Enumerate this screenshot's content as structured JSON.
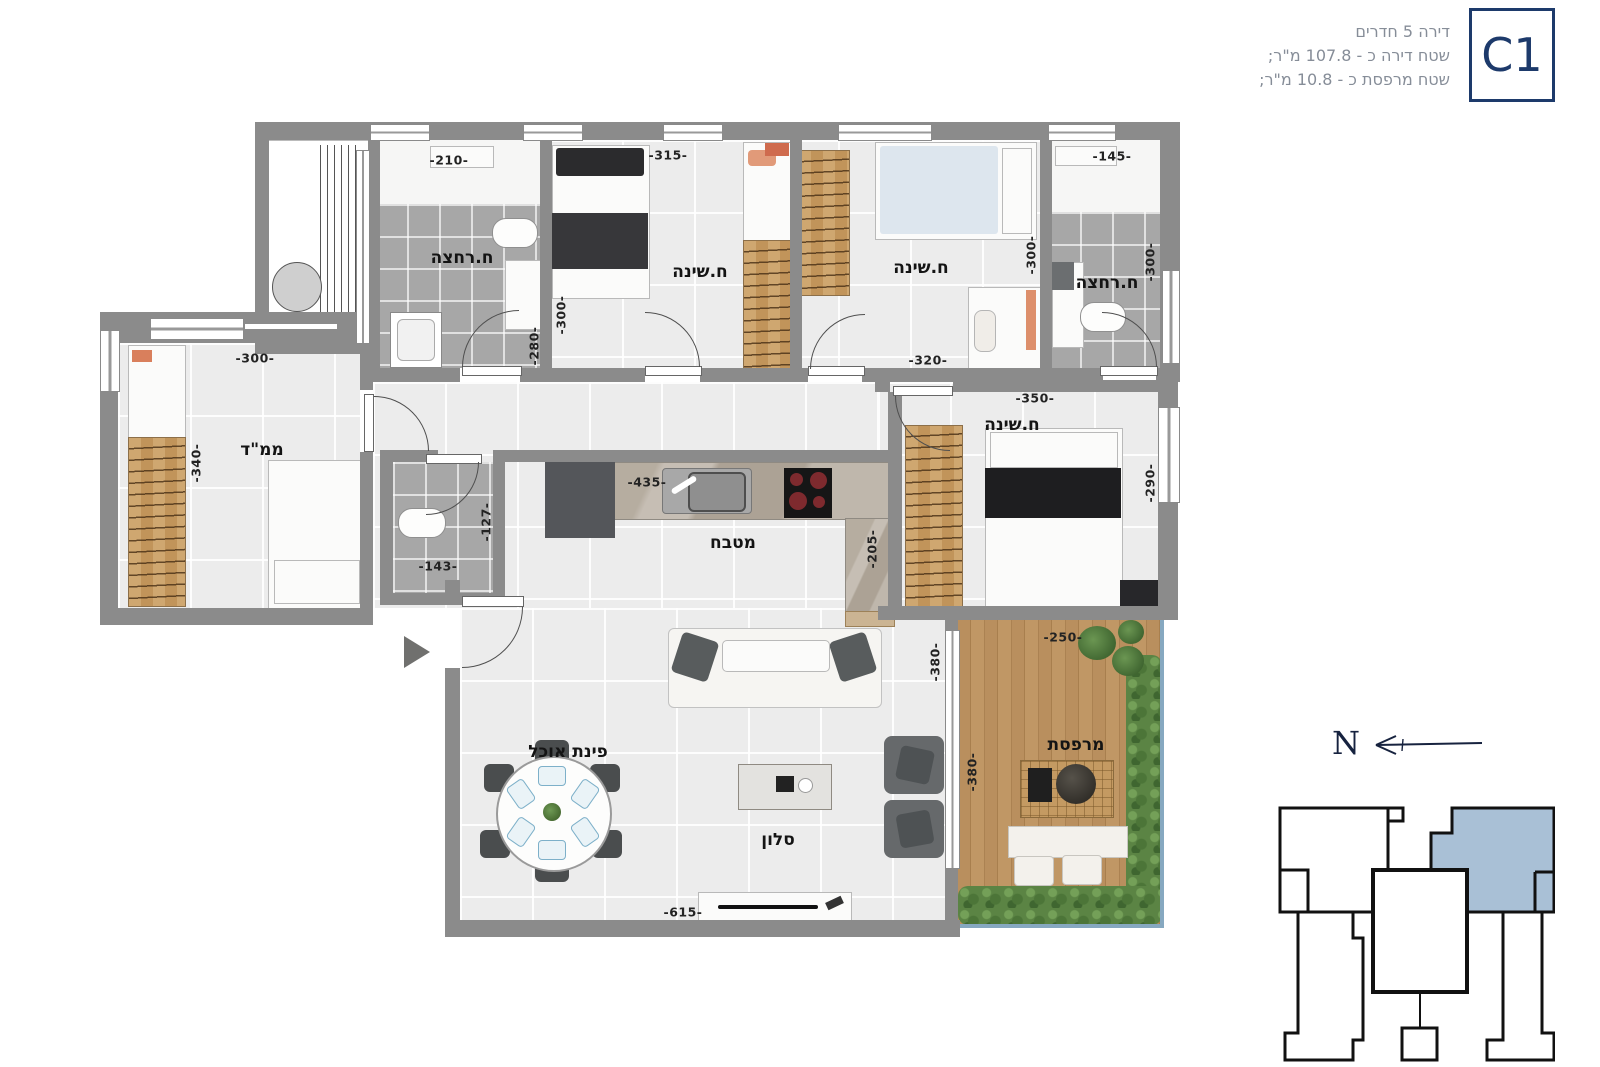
{
  "header": {
    "badge": "C1",
    "lines": {
      "l1": "דירה 5 חדרים",
      "l2": "שטח דירה כ - 107.8 מ\"ר;",
      "l3": "שטח מרפסת כ - 10.8 מ\"ר;"
    }
  },
  "labels": {
    "bath1": "ח.רחצה",
    "bedroom1": "ח.שינה",
    "bedroom2": "ח.שינה",
    "bath2": "ח.רחצה",
    "mamad": "ממ\"ד",
    "kitchen": "מטבח",
    "bedroom3": "ח.שינה",
    "dining": "פינת אוכל",
    "living": "סלון",
    "balcony": "מרפסת"
  },
  "dims": {
    "bath1_w": "-210-",
    "bath1_h": "-280-",
    "bedroom1_w": "-315-",
    "bedroom1_h": "-300-",
    "bedroom2_w": "-320-",
    "bedroom2_h": "-300-",
    "bath2_w": "-145-",
    "bath2_h": "-300-",
    "mamad_w": "-300-",
    "mamad_h": "-340-",
    "wc_w": "-143-",
    "wc_h": "-127-",
    "kitchen_w": "-435-",
    "kitchen_h": "-205-",
    "bedroom3_w": "-350-",
    "bedroom3_h": "-290-",
    "living_w": "-615-",
    "living_h": "-380-",
    "balcony_w": "-250-",
    "balcony_h": "-380-"
  },
  "compass": {
    "north": "N"
  },
  "colors": {
    "wall": "#8b8b8b",
    "floor": "#ececec",
    "bath_floor": "#a7a7a7",
    "wood": "#c1945a",
    "accent_navy": "#1d3a6b",
    "keyplan_highlight": "#a9c0d6"
  }
}
